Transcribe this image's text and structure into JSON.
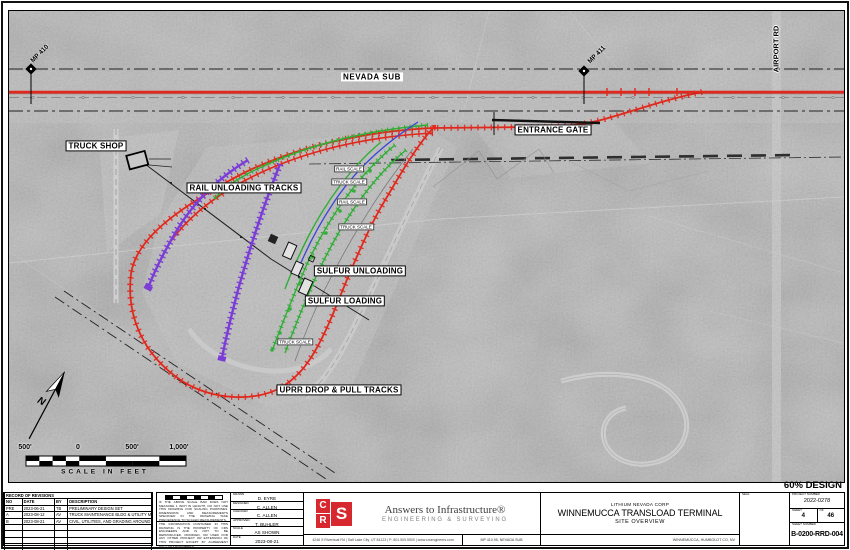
{
  "page": {
    "design_stage": "60% DESIGN"
  },
  "colors": {
    "track-red": "#e0281c",
    "track-green": "#2fae35",
    "track-purple": "#7b3dd6",
    "track-blue": "#3947d6",
    "logo-red": "#d7282f",
    "aerial-gray": "#b5b5b5"
  },
  "map": {
    "labels": [
      {
        "text": "NEVADA SUB",
        "x": 364,
        "y": 67,
        "cls": "plain"
      },
      {
        "text": "AIRPORT RD",
        "x": 769,
        "y": 39,
        "cls": "vertical"
      },
      {
        "text": "MP 410",
        "x": 32,
        "y": 44,
        "cls": "mp"
      },
      {
        "text": "MP 411",
        "x": 589,
        "y": 45,
        "cls": "mp"
      },
      {
        "text": "TRUCK SHOP",
        "x": 88,
        "y": 136,
        "cls": "boxed"
      },
      {
        "text": "RAIL UNLOADING TRACKS",
        "x": 236,
        "y": 178,
        "cls": "boxed"
      },
      {
        "text": "ENTRANCE GATE",
        "x": 545,
        "y": 120,
        "cls": "boxed"
      },
      {
        "text": "SULFUR UNLOADING",
        "x": 352,
        "y": 261,
        "cls": "boxed"
      },
      {
        "text": "SULFUR LOADING",
        "x": 337,
        "y": 291,
        "cls": "boxed"
      },
      {
        "text": "UPRR DROP & PULL TRACKS",
        "x": 331,
        "y": 380,
        "cls": "boxed"
      },
      {
        "text": "RAIL SCALE",
        "x": 341,
        "y": 159,
        "cls": "small"
      },
      {
        "text": "TRUCK SCALE",
        "x": 341,
        "y": 172,
        "cls": "small"
      },
      {
        "text": "RAIL SCALE",
        "x": 344,
        "y": 192,
        "cls": "small"
      },
      {
        "text": "TRUCK SCALE",
        "x": 348,
        "y": 217,
        "cls": "small"
      },
      {
        "text": "TRUCK SCALE",
        "x": 287,
        "y": 332,
        "cls": "small"
      },
      {
        "text": "500'",
        "x": 17,
        "y": 438,
        "cls": "tick"
      },
      {
        "text": "0",
        "x": 70,
        "y": 438,
        "cls": "tick"
      },
      {
        "text": "500'",
        "x": 124,
        "y": 438,
        "cls": "tick"
      },
      {
        "text": "1,000'",
        "x": 171,
        "y": 438,
        "cls": "tick"
      },
      {
        "text": "SCALE IN FEET",
        "x": 97,
        "y": 462,
        "cls": "caption"
      },
      {
        "text": "N",
        "x": 33,
        "y": 392,
        "cls": "north"
      }
    ]
  },
  "titleblock": {
    "revisions": {
      "title": "RECORD OF REVISIONS",
      "columns": [
        "NO",
        "DATE",
        "BY",
        "DESCRIPTION"
      ],
      "rows": [
        [
          "PRE",
          "2023-06-21",
          "TB",
          "PRELIMINARY DESIGN SET"
        ],
        [
          "A",
          "2023-08-12",
          "AV",
          "TRUCK MAINTENANCE BLDG & UTILITY MODIFICATIONS"
        ],
        [
          "B",
          "2023-08-21",
          "AV",
          "CIVIL, UTILITIES, AND GRADING AROUND TRUCK SHOP"
        ]
      ],
      "empty_rows": 4
    },
    "notes": {
      "scale_note": "IF THE ABOVE SCALE BAR DOES NOT MEASURE 1 INCH IN LENGTH, DO NOT USE THIS DRAWING FOR SCALING PURPOSES. DIMENSIONS AND MEASUREMENTS SPECIFIED IN THE DRAWING TAKE PRECEDENCE TO SCALED MEASUREMENTS.",
      "property_note": "THE INFORMATION CONTAINED IN THIS DRAWING IS THE PROPERTY OF CRS ENGINEERS AND IS NOT TO BE REPRODUCED, MODIFIED, OR USED FOR ANY OTHER PROJECT OR EXTENSION OF THIS PROJECT EXCEPT BY AGREEMENT WITH CRS ENGINEERS."
    },
    "credits": [
      {
        "label": "DRAWN",
        "value": "D. EYRE"
      },
      {
        "label": "DESIGNED",
        "value": "C. ALLEN"
      },
      {
        "label": "CHECKED",
        "value": "C. ALLEN"
      },
      {
        "label": "APPROVED",
        "value": "T. BUHLER"
      },
      {
        "label": "SCALE",
        "value": "AS SHOWN"
      },
      {
        "label": "DATE",
        "value": "2023-08-21"
      }
    ],
    "firm": {
      "logo": [
        "C",
        "S",
        "R"
      ],
      "tagline": "Answers to Infrastructure®",
      "division": "ENGINEERING & SURVEYING",
      "address": "4246 S Riverboat Rd | Salt Lake City, UT 84123 | P: 801.509.5500 | www.crsengineers.com",
      "location_ref": "MP 410.95, NEVADA SUB"
    },
    "project": {
      "client": "LITHIUM NEVADA CORP",
      "title": "WINNEMUCCA TRANSLOAD TERMINAL",
      "subtitle": "SITE OVERVIEW",
      "location": "WINNEMUCCA, HUMBOLDT CO, NV"
    },
    "seal_label": "SEAL",
    "numbers": {
      "project_number_label": "PROJECT NUMBER",
      "project_number": "2022-0278",
      "sheet_label": "SHEET",
      "sheet": "4",
      "of_label": "OF",
      "of": "46",
      "sheet_number_label": "SHEET NUMBER",
      "sheet_number": "B-0200-RRD-004"
    }
  }
}
